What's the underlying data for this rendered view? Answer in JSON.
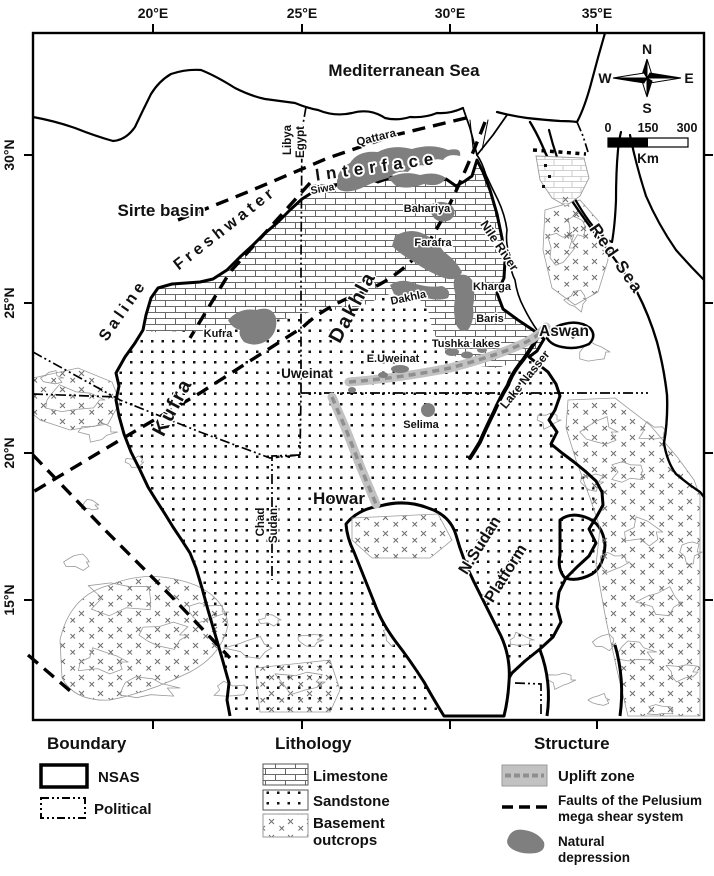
{
  "map": {
    "axis_top": [
      "20°E",
      "25°E",
      "30°E",
      "35°E"
    ],
    "axis_left": [
      "30°N",
      "25°N",
      "20°N",
      "15°N"
    ],
    "compass": {
      "n": "N",
      "e": "E",
      "s": "S",
      "w": "W"
    },
    "scalebar": {
      "t0": "0",
      "t1": "150",
      "t2": "300",
      "unit": "Km"
    },
    "seas": {
      "mediterranean": "Mediterranean Sea",
      "red_sea": "Red Sea"
    },
    "countries": {
      "libya": "Libya",
      "egypt": "Egypt",
      "chad": "Chad",
      "sudan": "Sudan."
    },
    "basins": {
      "sirte": "Sirte basin",
      "kufra": "Kufra",
      "dakhla": "Dakhla",
      "howar": "Howar",
      "nsudan_line1": "N.Sudan",
      "nsudan_line2": "Platform"
    },
    "interface_label": {
      "word1": "Saline",
      "word2": "Freshwater",
      "word3": "Interface"
    },
    "places": {
      "qattara": "Qattara",
      "siwa": "Siwa",
      "bahariya": "Bahariya",
      "farafra": "Farafra",
      "dakhla": "Dakhla",
      "kharga": "Kharga",
      "baris": "Baris",
      "tushka": "Tushka lakes",
      "e_uweinat": "E.Uweinat",
      "uweinat": "Uweinat",
      "selima": "Selima",
      "kufra": "Kufra",
      "aswan": "Aswan"
    },
    "water": {
      "nile": "Nile River",
      "lake_nasser": "Lake Nasser"
    }
  },
  "legend": {
    "boundary": {
      "title": "Boundary",
      "nsas": "NSAS",
      "political": "Political"
    },
    "lithology": {
      "title": "Lithology",
      "limestone": "Limestone",
      "sandstone": "Sandstone",
      "basement_line1": "Basement",
      "basement_line2": "outcrops"
    },
    "structure": {
      "title": "Structure",
      "uplift": "Uplift zone",
      "faults_line1": "Faults of the Pelusium",
      "faults_line2": "mega shear system",
      "depression_line1": "Natural",
      "depression_line2": "depression"
    }
  },
  "colors": {
    "depression": "#7f7f7f",
    "uplift_band": "#c2c2c2",
    "uplift_dash": "#8f8f8f",
    "contour": "#9a9a9a",
    "ink": "#111111"
  }
}
